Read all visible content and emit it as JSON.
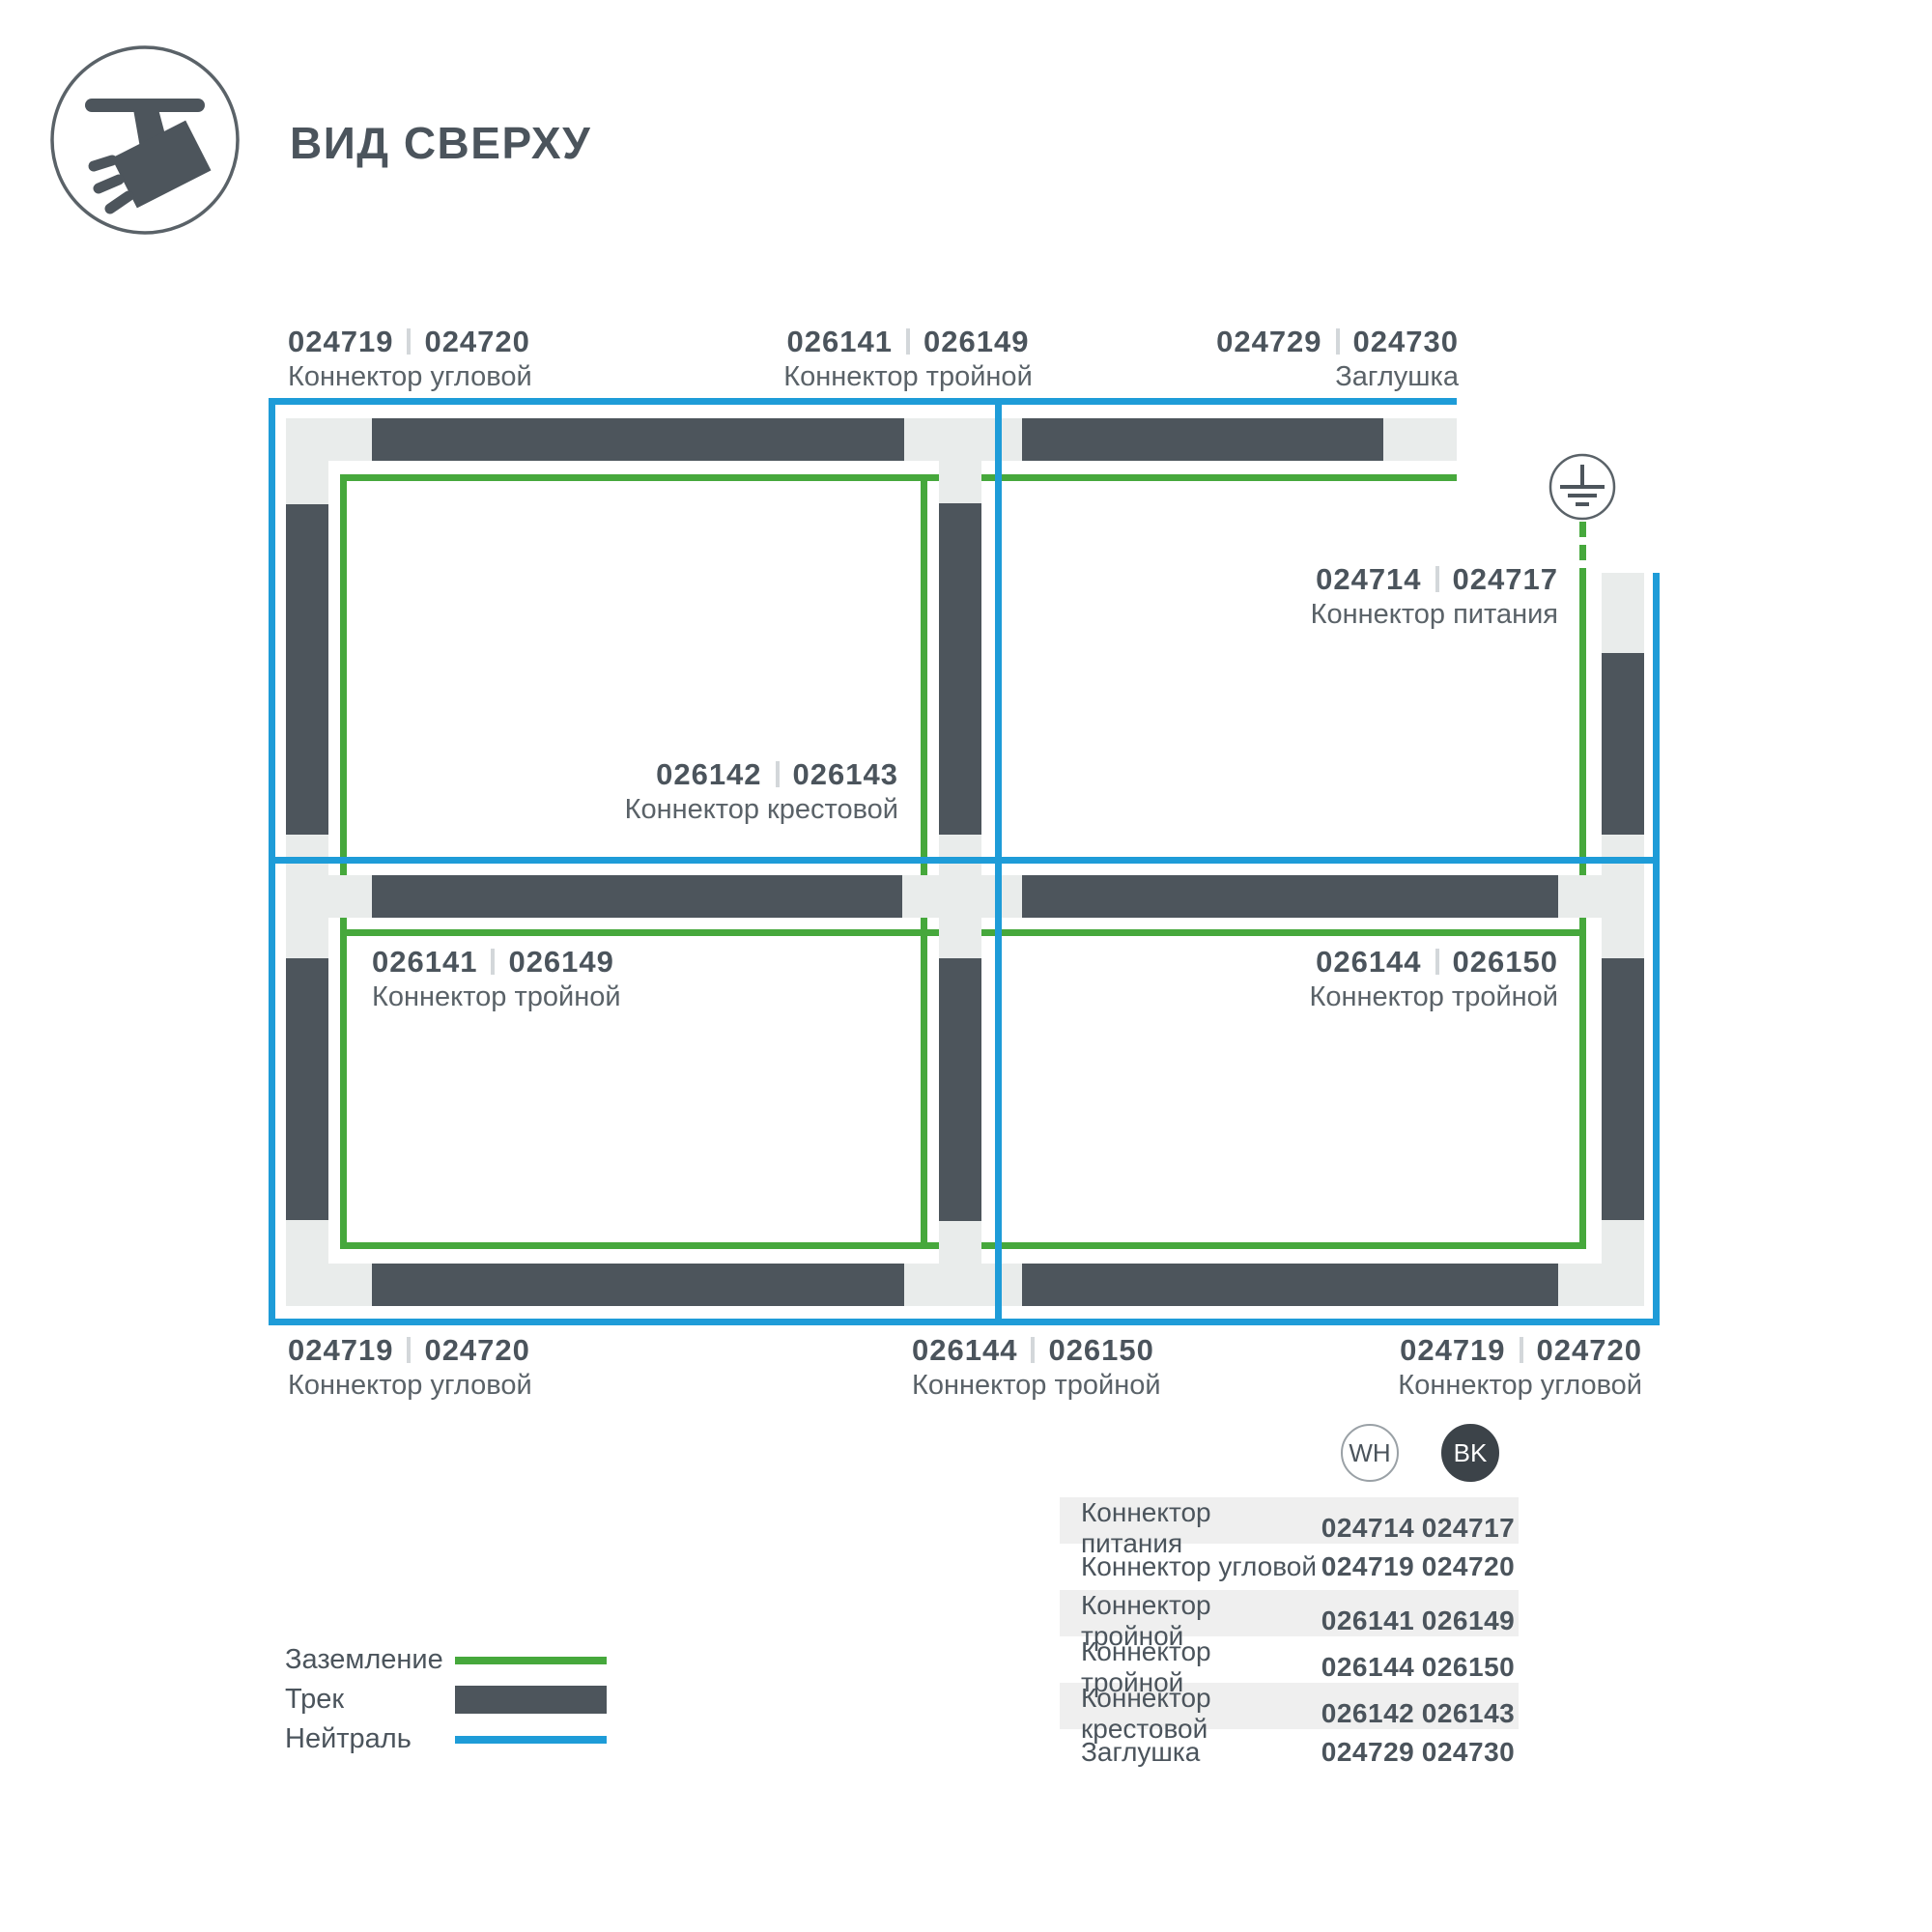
{
  "header": {
    "title": "ВИД СВЕРХУ",
    "icon": "track-spotlight-top-view-icon"
  },
  "diagram": {
    "ground_symbol": "earth-ground-icon",
    "labels": {
      "top_left": {
        "wh": "024719",
        "bk": "024720",
        "name": "Коннектор угловой"
      },
      "top_center": {
        "wh": "026141",
        "bk": "026149",
        "name": "Коннектор тройной"
      },
      "top_right": {
        "wh": "024729",
        "bk": "024730",
        "name": "Заглушка"
      },
      "power": {
        "wh": "024714",
        "bk": "024717",
        "name": "Коннектор питания"
      },
      "cross": {
        "wh": "026142",
        "bk": "026143",
        "name": "Коннектор крестовой"
      },
      "mid_left": {
        "wh": "026141",
        "bk": "026149",
        "name": "Коннектор тройной"
      },
      "mid_right": {
        "wh": "026144",
        "bk": "026150",
        "name": "Коннектор тройной"
      },
      "bottom_left": {
        "wh": "024719",
        "bk": "024720",
        "name": "Коннектор угловой"
      },
      "bottom_center": {
        "wh": "026144",
        "bk": "026150",
        "name": "Коннектор тройной"
      },
      "bottom_right": {
        "wh": "024719",
        "bk": "024720",
        "name": "Коннектор угловой"
      }
    }
  },
  "legend": {
    "items": [
      {
        "label": "Заземление",
        "swatch": "green-line"
      },
      {
        "label": "Трек",
        "swatch": "dark-bar"
      },
      {
        "label": "Нейтраль",
        "swatch": "blue-line"
      }
    ]
  },
  "table": {
    "columns": [
      {
        "label": "WH"
      },
      {
        "label": "BK"
      }
    ],
    "rows": [
      {
        "name": "Коннектор питания",
        "wh": "024714",
        "bk": "024717"
      },
      {
        "name": "Коннектор угловой",
        "wh": "024719",
        "bk": "024720"
      },
      {
        "name": "Коннектор тройной",
        "wh": "026141",
        "bk": "026149"
      },
      {
        "name": "Коннектор тройной",
        "wh": "026144",
        "bk": "026150"
      },
      {
        "name": "Коннектор крестовой",
        "wh": "026142",
        "bk": "026143"
      },
      {
        "name": "Заглушка",
        "wh": "024729",
        "bk": "024730"
      }
    ]
  },
  "colors": {
    "ground_green": "#46a83c",
    "neutral_blue": "#1e9cd8",
    "track_dark": "#4d555c",
    "connector_light": "#e9eceb",
    "text_dark": "#4b545c"
  }
}
